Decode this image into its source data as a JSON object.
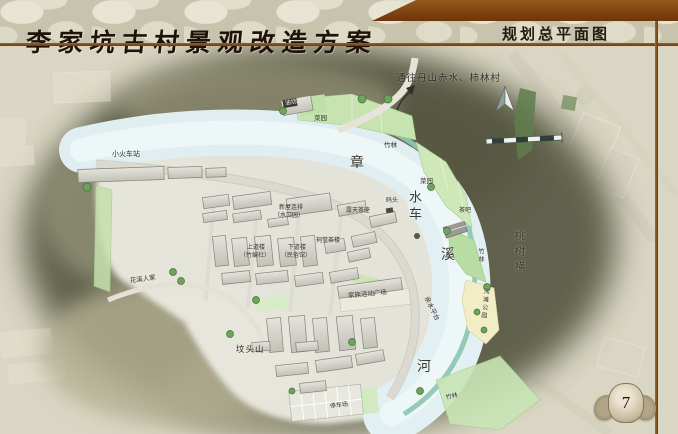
{
  "palette": {
    "banner_brown": "#7b3d0e",
    "rule_brown": "#8a4f1d",
    "page_background": "#d8d5c1",
    "hill_shadow_olive": "#575842",
    "river_blue": "#e2eff3",
    "stream_teal": "#8fc6b4",
    "bamboo_green": "#c6e3b0",
    "beach_cream": "#f1edc4"
  },
  "header": {
    "title": "李家坑古村景观改造方案",
    "section_title": "规划总平面图"
  },
  "page_number": "7",
  "map": {
    "direction_note": "通往丹山赤水、柿林村",
    "compass": "north-arrow",
    "scale_bar": "graphic-scale",
    "labels": [
      "通往丹山赤水、柿林村",
      "小火车站",
      "油坊",
      "菜园",
      "竹林",
      "章",
      "菜园",
      "水车",
      "码头",
      "露天茶座",
      "茶吧",
      "新屋连排",
      "（水口园）",
      "上道楼",
      "（竹编社）",
      "下道楼",
      "（民俗馆）",
      "祠堂茶楼",
      "溪",
      "桃树横",
      "竹林",
      "河滩公园",
      "家族活动广场",
      "亲水平台",
      "花溪人家",
      "坟头山",
      "河",
      "竹林",
      "停车场"
    ]
  }
}
